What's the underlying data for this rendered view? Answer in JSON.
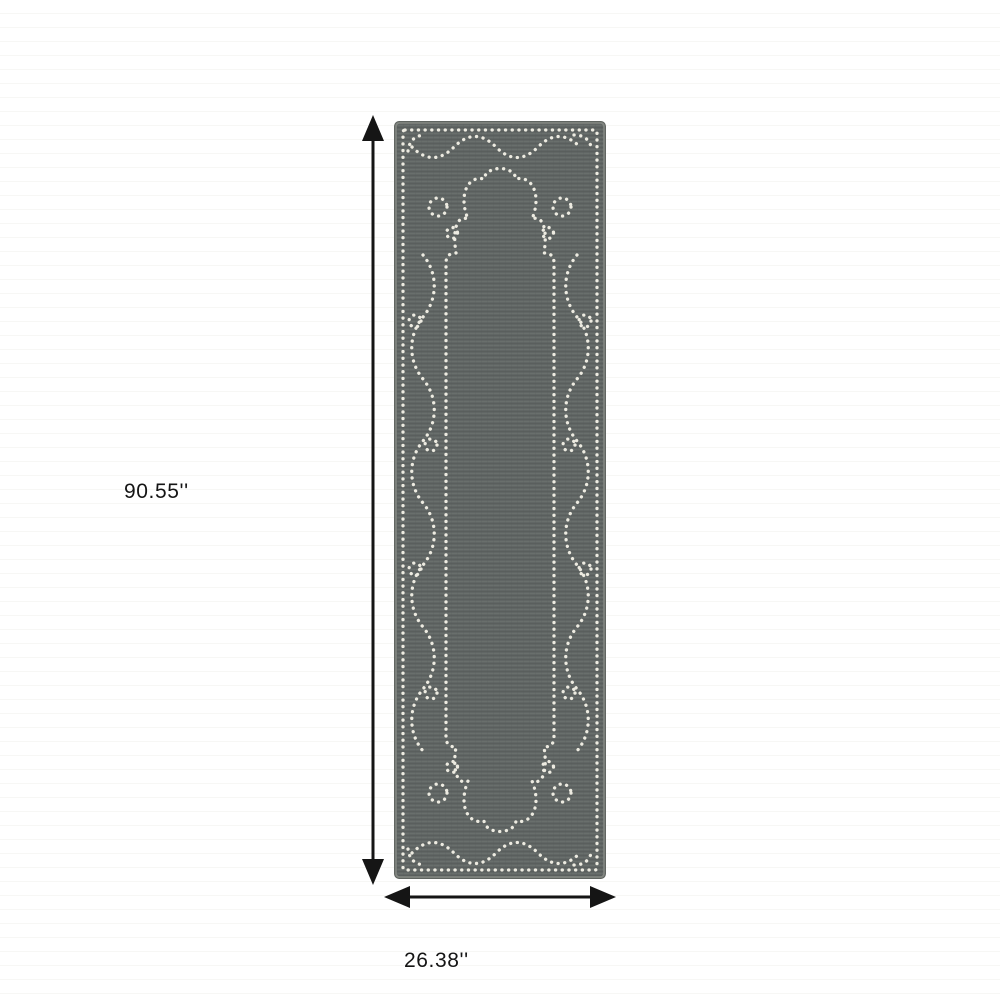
{
  "meta": {
    "description": "Dimension diagram of a grey runner rug with a white dotted scroll border"
  },
  "labels": {
    "height": "90.55''",
    "width": "26.38''"
  },
  "icons": {
    "height_arrow": "vertical double-headed dimension arrow",
    "width_arrow": "horizontal double-headed dimension arrow"
  },
  "colors": {
    "bg": "#ffffff",
    "stripe": "#f7f7f5",
    "field": "#616665",
    "weaveLight": "#6e7371",
    "weaveDark": "#565b59",
    "edge": "#838782",
    "edgeDark": "#545855",
    "dot": "#edebe1",
    "ink": "#151515"
  }
}
